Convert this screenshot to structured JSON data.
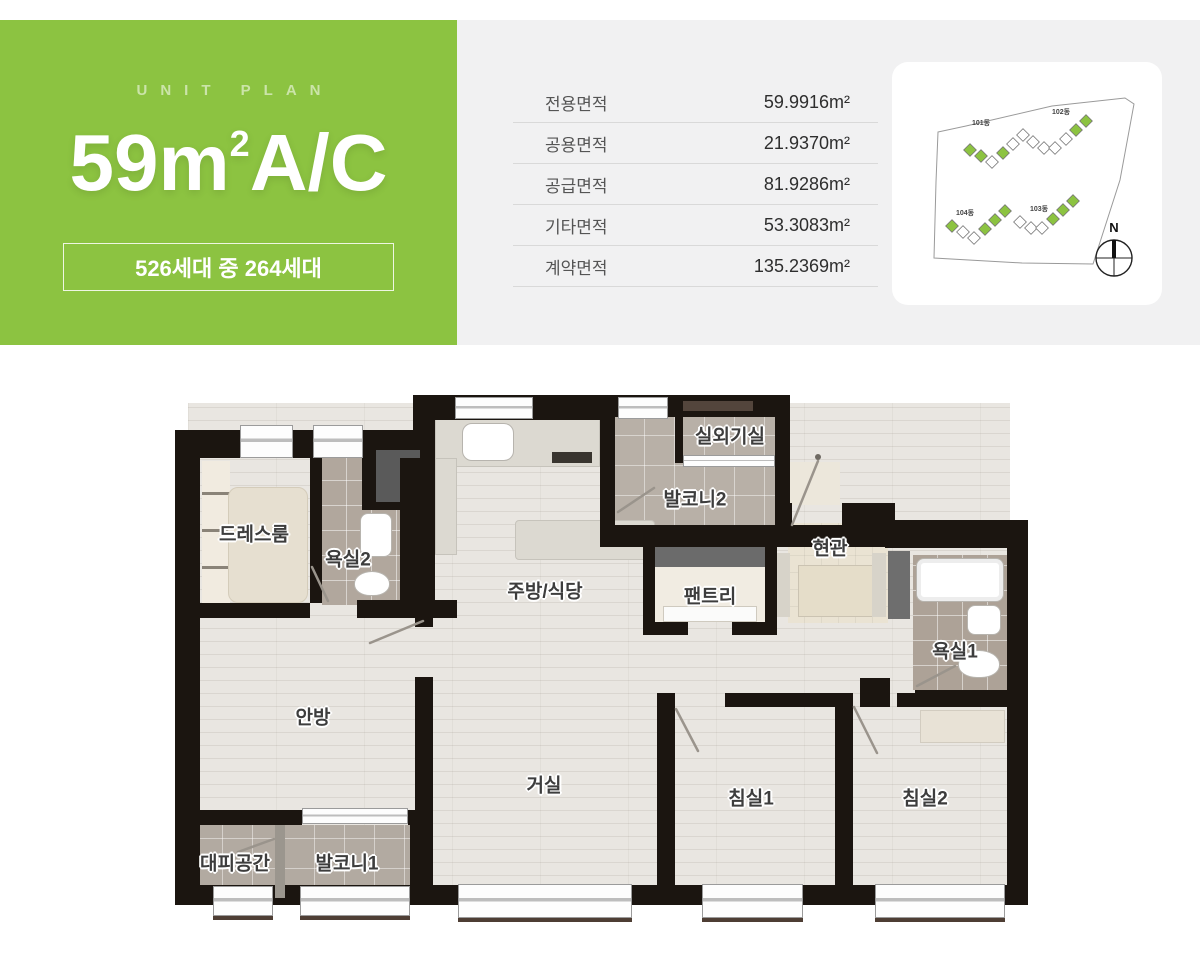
{
  "header": {
    "eyebrow": "UNIT PLAN",
    "title_prefix": "59m",
    "title_sup": "2",
    "title_suffix": "A/C",
    "badge": "526세대 중 264세대"
  },
  "area_table": {
    "unit": "m²",
    "rows": [
      {
        "label": "전용면적",
        "value": "59.9916"
      },
      {
        "label": "공용면적",
        "value": "21.9370"
      },
      {
        "label": "공급면적",
        "value": "81.9286"
      },
      {
        "label": "기타면적",
        "value": "53.3083"
      },
      {
        "label": "계약면적",
        "value": "135.2369"
      }
    ]
  },
  "site_plan": {
    "compass": "N",
    "buildings": [
      {
        "name": "101동"
      },
      {
        "name": "102동"
      },
      {
        "name": "103동"
      },
      {
        "name": "104동"
      }
    ]
  },
  "floor_plan": {
    "rooms": [
      {
        "id": "dressroom",
        "label": "드레스룸"
      },
      {
        "id": "bath2",
        "label": "욕실2"
      },
      {
        "id": "kitchen-dining",
        "label": "주방/식당"
      },
      {
        "id": "balcony2",
        "label": "발코니2"
      },
      {
        "id": "ac-unit-room",
        "label": "실외기실"
      },
      {
        "id": "pantry",
        "label": "팬트리"
      },
      {
        "id": "entry",
        "label": "현관"
      },
      {
        "id": "bath1",
        "label": "욕실1"
      },
      {
        "id": "master-bedroom",
        "label": "안방"
      },
      {
        "id": "living-room",
        "label": "거실"
      },
      {
        "id": "bedroom1",
        "label": "침실1"
      },
      {
        "id": "bedroom2",
        "label": "침실2"
      },
      {
        "id": "shelter",
        "label": "대피공간"
      },
      {
        "id": "balcony1",
        "label": "발코니1"
      }
    ]
  },
  "colors": {
    "accent_green": "#8cc341",
    "band_gray": "#f1f1f2",
    "wall_black": "#1b1510",
    "wood_floor": "#e9e6e1",
    "tile_gray": "#b8b0a7"
  }
}
